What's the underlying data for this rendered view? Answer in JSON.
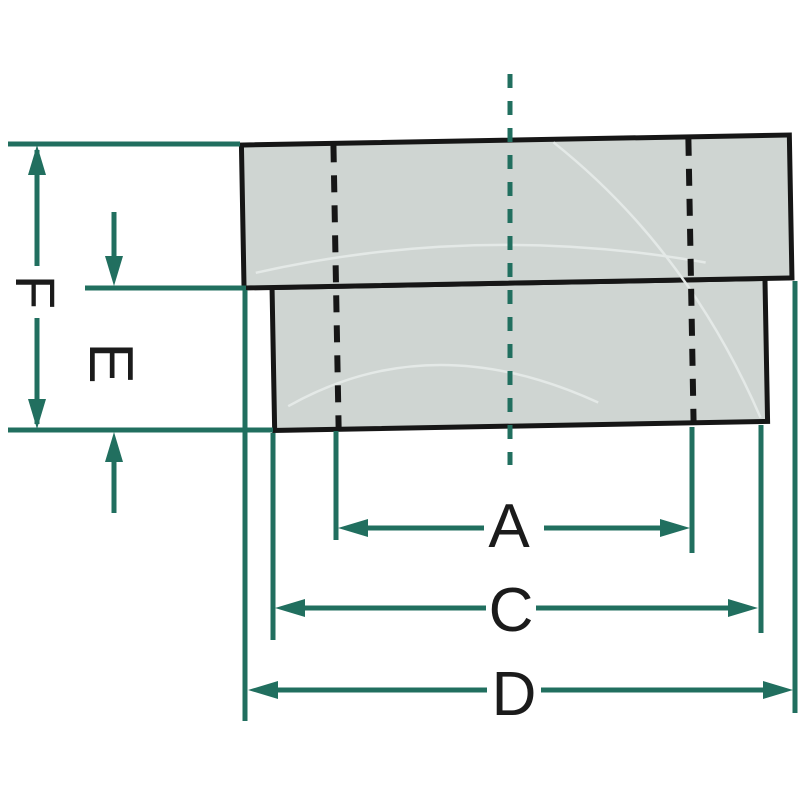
{
  "figure": {
    "dimension_labels": {
      "a": "A",
      "c": "C",
      "d": "D",
      "e": "E",
      "f": "F"
    },
    "colors": {
      "dimension_line": "#216f5f",
      "part_outline": "#161616",
      "part_fill": "#cfd5d2",
      "watermark_curve": "#e4e9e7",
      "label_text": "#1b1b1b",
      "background": "#ffffff"
    }
  }
}
